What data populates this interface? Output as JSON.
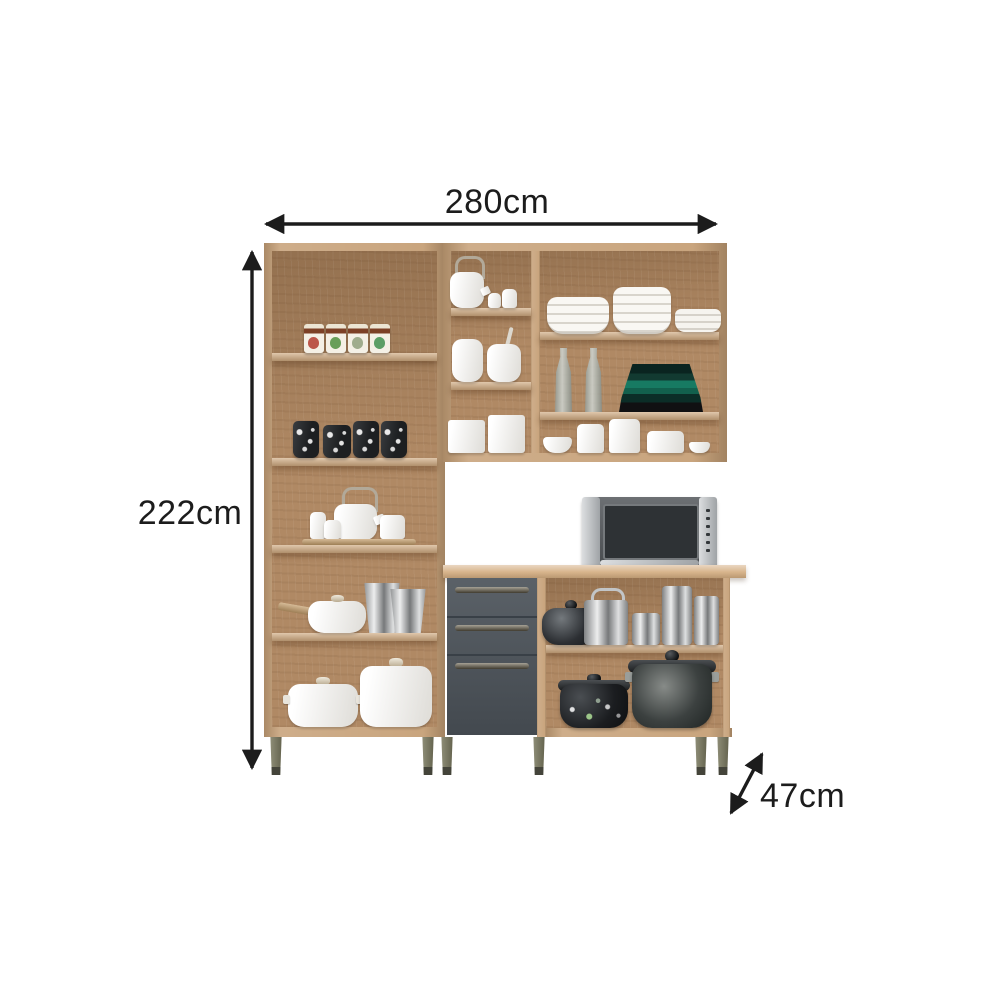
{
  "page": {
    "background": "#ffffff",
    "description": "Product dimension photo of a kitchen cabinet set: tall oak pantry shelf, wall cabinet and base cabinet with graphite drawers, filled with kitchenware"
  },
  "dimensions": {
    "width_label": "280cm",
    "height_label": "222cm",
    "depth_label": "47cm"
  },
  "colors": {
    "wood": "#c6a077",
    "wood-light": "#dcbd93",
    "wood-dark": "#ac835c",
    "wood-shelf": "#cfa97f",
    "counter": "#d4ae82",
    "drawer-gray": "#4e555c",
    "handle-bronze": "#6b6450",
    "leg-olive": "#7b7a5f",
    "leg-foot": "#44443a",
    "arrow": "#1c1c1c",
    "plate-teal": "#177a62",
    "steel": "#b6b9bb",
    "microwave-body": "#585c60",
    "white-ware": "#f4f2ed"
  },
  "contents": {
    "tall_cabinet": [
      "food tins",
      "patterned black mugs",
      "white tea set on wooden tray",
      "saucepan with wood handle",
      "metal buckets",
      "two lidded white pots"
    ],
    "wall_cabinet": [
      "white kettle with swing handle",
      "creamers",
      "storage jars",
      "square canisters",
      "stacked white bowls",
      "stacked white plates",
      "glass bottles",
      "green plate stack",
      "small bowls and canisters"
    ],
    "base_cabinet": [
      "microwave oven",
      "black teapot",
      "steel kettle",
      "steel canisters",
      "floral stew pot",
      "large stock pot"
    ]
  }
}
